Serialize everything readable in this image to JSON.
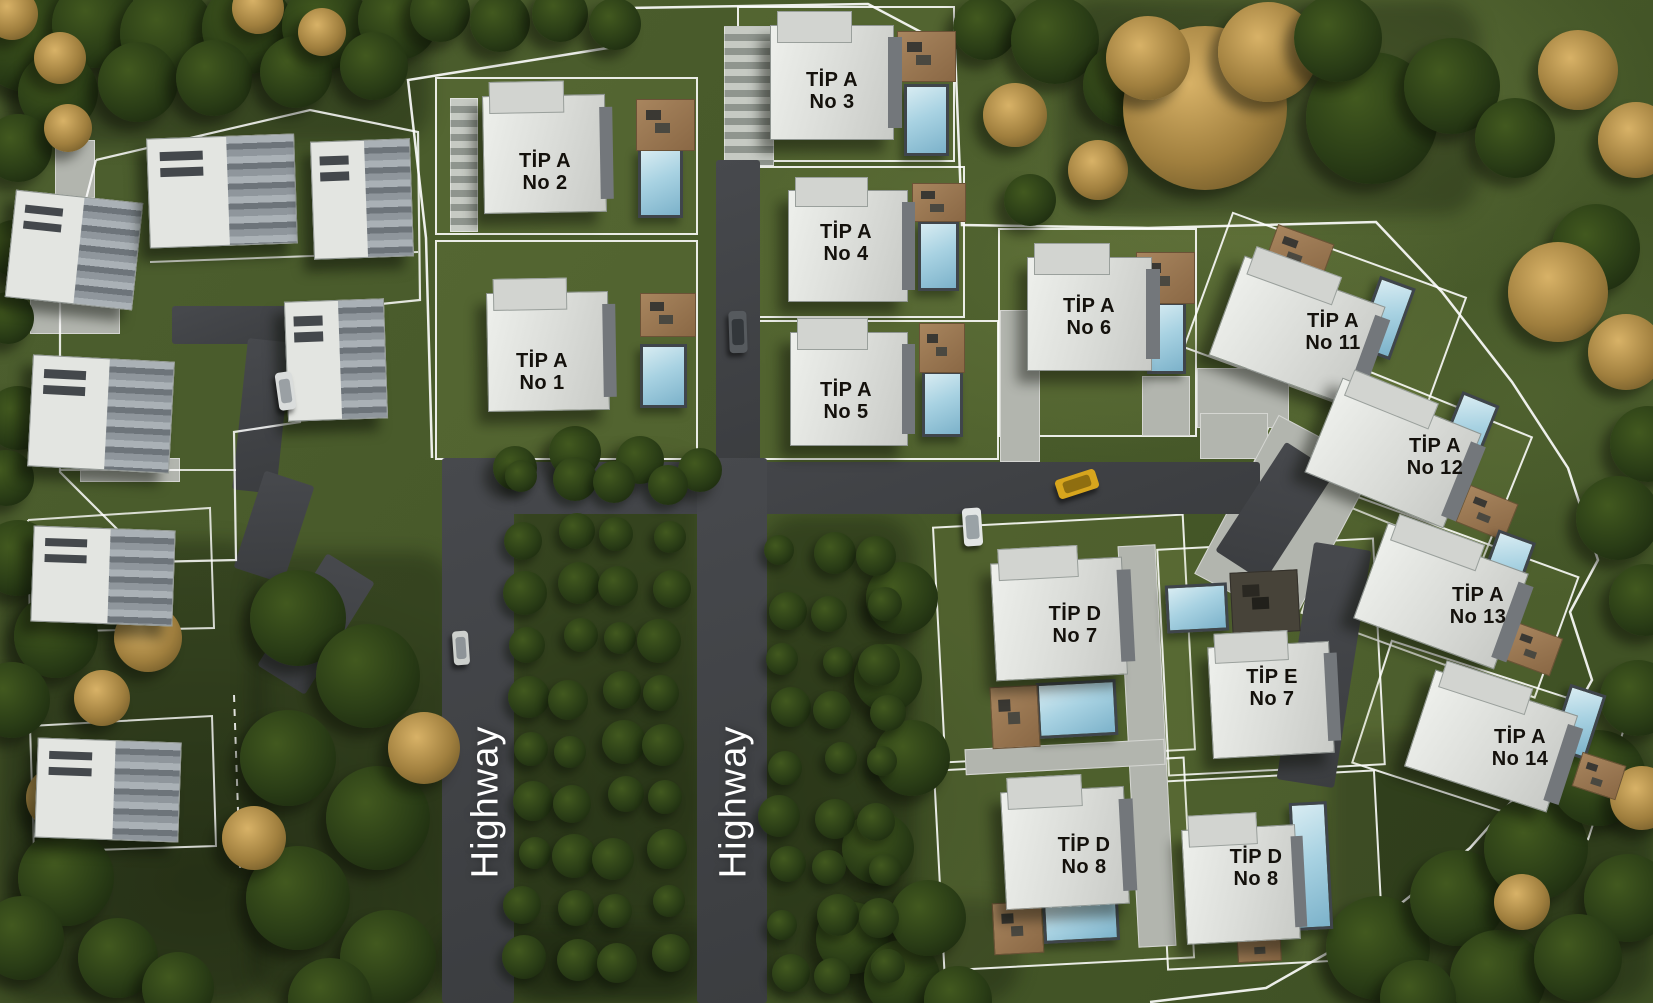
{
  "labels": {
    "highway_west": "Highway",
    "highway_east": "Highway"
  },
  "colors": {
    "grass": "#46572b",
    "asphalt": "#3e4043",
    "pavement": "#b2b5ae",
    "building": "#e0e2de",
    "pool": "#9ecbdd",
    "deck": "#8d6d4d",
    "boundary_line": "#ffffff",
    "label_text": "#14110c",
    "highway_text": "#ffffff",
    "taxi": "#d7a51d"
  },
  "villas": [
    {
      "name": "villa-tip-a-no-2",
      "type_label": "TİP A",
      "no_label": "No 2",
      "lot": [
        435,
        77,
        263,
        158,
        0
      ],
      "building": [
        483,
        95,
        121,
        116,
        -1
      ],
      "pool": [
        638,
        148,
        45,
        70,
        0
      ],
      "deck": [
        636,
        99,
        57,
        50,
        0
      ],
      "label": [
        545,
        172
      ]
    },
    {
      "name": "villa-tip-a-no-1",
      "type_label": "TİP A",
      "no_label": "No 1",
      "lot": [
        435,
        240,
        263,
        220,
        0
      ],
      "building": [
        487,
        292,
        120,
        117,
        -1
      ],
      "pool": [
        640,
        344,
        47,
        64,
        0
      ],
      "deck": [
        640,
        293,
        54,
        42,
        0
      ],
      "label": [
        542,
        372
      ]
    },
    {
      "name": "villa-tip-a-no-3",
      "type_label": "TİP A",
      "no_label": "No 3",
      "lot": [
        737,
        6,
        218,
        156,
        0
      ],
      "building": [
        770,
        25,
        122,
        113,
        0
      ],
      "pool": [
        904,
        84,
        45,
        72,
        0
      ],
      "deck": [
        897,
        31,
        57,
        49,
        0
      ],
      "label": [
        832,
        91
      ]
    },
    {
      "name": "villa-tip-a-no-4",
      "type_label": "TİP A",
      "no_label": "No 4",
      "lot": [
        737,
        166,
        228,
        152,
        0
      ],
      "building": [
        788,
        190,
        118,
        110,
        0
      ],
      "pool": [
        918,
        221,
        41,
        70,
        0
      ],
      "deck": [
        912,
        183,
        52,
        37,
        0
      ],
      "label": [
        846,
        243
      ]
    },
    {
      "name": "villa-tip-a-no-5",
      "type_label": "TİP A",
      "no_label": "No 5",
      "lot": [
        737,
        320,
        262,
        140,
        0
      ],
      "building": [
        790,
        332,
        116,
        112,
        0
      ],
      "pool": [
        922,
        371,
        41,
        66,
        0
      ],
      "deck": [
        919,
        323,
        44,
        48,
        0
      ],
      "label": [
        846,
        401
      ]
    },
    {
      "name": "villa-tip-a-no-6",
      "type_label": "TİP A",
      "no_label": "No 6",
      "lot": [
        998,
        228,
        199,
        209,
        0
      ],
      "building": [
        1027,
        257,
        123,
        112,
        0
      ],
      "pool": [
        1147,
        302,
        39,
        72,
        0
      ],
      "deck": [
        1136,
        252,
        57,
        50,
        0
      ],
      "label": [
        1089,
        317
      ]
    },
    {
      "name": "villa-tip-a-no-11",
      "type_label": "TİP A",
      "no_label": "No 11",
      "lot": [
        1200,
        250,
        250,
        145,
        20
      ],
      "building": [
        1222,
        278,
        148,
        104,
        20
      ],
      "pool": [
        1366,
        280,
        38,
        76,
        20
      ],
      "deck": [
        1269,
        233,
        58,
        41,
        20
      ],
      "label": [
        1333,
        332
      ]
    },
    {
      "name": "villa-tip-a-no-12",
      "type_label": "TİP A",
      "no_label": "No 12",
      "lot": [
        1267,
        385,
        250,
        135,
        22
      ],
      "building": [
        1318,
        402,
        148,
        100,
        22
      ],
      "pool": [
        1448,
        396,
        40,
        70,
        22
      ],
      "deck": [
        1461,
        493,
        50,
        38,
        22
      ],
      "label": [
        1435,
        457
      ]
    },
    {
      "name": "villa-tip-a-no-13",
      "type_label": "TİP A",
      "no_label": "No 13",
      "lot": [
        1315,
        530,
        250,
        130,
        20
      ],
      "building": [
        1366,
        545,
        148,
        100,
        20
      ],
      "pool": [
        1485,
        534,
        40,
        72,
        20
      ],
      "deck": [
        1508,
        629,
        48,
        38,
        20
      ],
      "label": [
        1478,
        606
      ]
    },
    {
      "name": "villa-tip-a-no-14",
      "type_label": "TİP A",
      "no_label": "No 14",
      "lot": [
        1365,
        675,
        250,
        130,
        18
      ],
      "building": [
        1416,
        690,
        148,
        100,
        18
      ],
      "pool": [
        1559,
        688,
        38,
        68,
        18
      ],
      "deck": [
        1576,
        758,
        44,
        34,
        18
      ],
      "label": [
        1520,
        748
      ]
    },
    {
      "name": "villa-tip-d-no-7",
      "type_label": "TİP D",
      "no_label": "No 7",
      "lot": [
        938,
        520,
        252,
        237,
        -3
      ],
      "building": [
        993,
        560,
        130,
        116,
        -3
      ],
      "pool": [
        1037,
        681,
        80,
        56,
        -3
      ],
      "deck": [
        991,
        686,
        46,
        60,
        -3
      ],
      "label": [
        1075,
        625
      ]
    },
    {
      "name": "villa-tip-e-no-7",
      "type_label": "TİP E",
      "no_label": "No 7",
      "lot": [
        1162,
        543,
        218,
        228,
        -3
      ],
      "building": [
        1210,
        644,
        120,
        110,
        -3
      ],
      "pool": [
        1166,
        584,
        62,
        48,
        -3
      ],
      "deck": [
        1231,
        571,
        66,
        60,
        -3
      ],
      "deck_dark": true,
      "label": [
        1272,
        688
      ]
    },
    {
      "name": "villa-tip-d-no-8-west",
      "type_label": "TİP D",
      "no_label": "No 8",
      "lot": [
        938,
        763,
        252,
        202,
        -3
      ],
      "building": [
        1003,
        789,
        122,
        116,
        -3
      ],
      "pool": [
        1043,
        898,
        76,
        44,
        -3
      ],
      "deck": [
        993,
        902,
        48,
        50,
        -3
      ],
      "label": [
        1084,
        856
      ]
    },
    {
      "name": "villa-tip-d-no-8-east",
      "type_label": "TİP D",
      "no_label": "No 8",
      "lot": [
        1162,
        775,
        218,
        190,
        -3
      ],
      "building": [
        1184,
        827,
        112,
        113,
        -3
      ],
      "pool": [
        1292,
        802,
        38,
        128,
        -3
      ],
      "deck": [
        1237,
        926,
        42,
        34,
        -3
      ],
      "label": [
        1256,
        868
      ]
    }
  ],
  "other_buildings": [
    {
      "name": "existing-building-west-1",
      "rect": [
        10,
        196,
        126,
        106,
        6
      ]
    },
    {
      "name": "existing-building-west-2",
      "rect": [
        148,
        136,
        146,
        108,
        -2
      ]
    },
    {
      "name": "existing-building-west-3",
      "rect": [
        312,
        140,
        98,
        116,
        -2
      ]
    },
    {
      "name": "existing-building-west-4",
      "rect": [
        30,
        358,
        140,
        110,
        3
      ]
    },
    {
      "name": "existing-building-west-5",
      "rect": [
        286,
        300,
        98,
        118,
        -2
      ]
    },
    {
      "name": "existing-building-west-6",
      "rect": [
        32,
        528,
        140,
        94,
        2
      ]
    },
    {
      "name": "existing-building-west-7",
      "rect": [
        36,
        740,
        142,
        98,
        2
      ]
    }
  ],
  "roads": [
    {
      "name": "main-road",
      "rect": [
        442,
        462,
        818,
        52,
        0
      ]
    },
    {
      "name": "road-bend-east",
      "rect": [
        1246,
        447,
        58,
        130,
        33
      ]
    },
    {
      "name": "road-east-south",
      "rect": [
        1295,
        545,
        58,
        240,
        9
      ]
    },
    {
      "name": "road-north-center",
      "rect": [
        716,
        160,
        44,
        302,
        0
      ]
    },
    {
      "name": "highway-west-road",
      "rect": [
        442,
        458,
        72,
        545,
        0
      ]
    },
    {
      "name": "highway-east-road",
      "rect": [
        697,
        458,
        70,
        545,
        0
      ]
    },
    {
      "name": "cluster-road-a",
      "rect": [
        172,
        306,
        142,
        38,
        0
      ]
    },
    {
      "name": "cluster-road-b",
      "rect": [
        240,
        340,
        44,
        152,
        6
      ]
    },
    {
      "name": "cluster-road-c",
      "rect": [
        248,
        476,
        52,
        102,
        18
      ]
    },
    {
      "name": "cluster-road-d",
      "rect": [
        288,
        558,
        56,
        132,
        32
      ]
    }
  ],
  "pavements": [
    {
      "name": "parking-strip-no2",
      "rect": [
        450,
        98,
        28,
        134,
        0
      ],
      "striped": true
    },
    {
      "name": "parking-strip-no3",
      "rect": [
        724,
        26,
        50,
        140,
        0
      ],
      "striped": true
    },
    {
      "name": "walkway-no6",
      "rect": [
        1000,
        310,
        40,
        152,
        0
      ]
    },
    {
      "name": "lounger-patio-no6",
      "rect": [
        1142,
        376,
        48,
        60,
        0
      ]
    },
    {
      "name": "driveway-no11",
      "rect": [
        1197,
        368,
        92,
        60,
        0
      ]
    },
    {
      "name": "driveway-no11-south",
      "rect": [
        1200,
        413,
        68,
        46,
        0
      ]
    },
    {
      "name": "driveway-east-villas",
      "rect": [
        1230,
        430,
        110,
        180,
        28
      ]
    },
    {
      "name": "walkway-southeast-vertical",
      "rect": [
        1128,
        545,
        38,
        402,
        -3
      ]
    },
    {
      "name": "walkway-southeast-horizontal",
      "rect": [
        965,
        744,
        200,
        26,
        -3
      ]
    },
    {
      "name": "pad-west-1",
      "rect": [
        30,
        298,
        90,
        36,
        0
      ]
    },
    {
      "name": "pad-west-2",
      "rect": [
        55,
        140,
        40,
        58,
        0
      ]
    },
    {
      "name": "pad-west-3",
      "rect": [
        80,
        458,
        100,
        24,
        0
      ]
    }
  ],
  "cars": [
    {
      "name": "yellow-taxi",
      "rect": [
        1056,
        474,
        42,
        20,
        -18
      ],
      "body": "#d7a51d",
      "glass": "#8f6e10"
    },
    {
      "name": "white-car-south",
      "rect": [
        963,
        508,
        19,
        38,
        -4
      ],
      "body": "#e3e6e5",
      "glass": "#9aa2a6"
    },
    {
      "name": "gray-car-north",
      "rect": [
        729,
        311,
        18,
        42,
        -2
      ],
      "body": "#565a5e",
      "glass": "#33373b"
    },
    {
      "name": "white-car-west",
      "rect": [
        277,
        372,
        17,
        38,
        -8
      ],
      "body": "#dadddc",
      "glass": "#9aa0a4"
    },
    {
      "name": "white-car-orchard",
      "rect": [
        453,
        631,
        16,
        34,
        -4
      ],
      "body": "#cdd0cd",
      "glass": "#8e9498"
    }
  ],
  "trees": [
    [
      28,
      38,
      54,
      "d"
    ],
    [
      96,
      24,
      44,
      "d"
    ],
    [
      168,
      34,
      48,
      "d"
    ],
    [
      248,
      28,
      46,
      "d"
    ],
    [
      326,
      26,
      44,
      "d"
    ],
    [
      398,
      20,
      40,
      "d"
    ],
    [
      58,
      92,
      40,
      "d"
    ],
    [
      138,
      82,
      40,
      "d"
    ],
    [
      214,
      78,
      38,
      "d"
    ],
    [
      296,
      72,
      36,
      "d"
    ],
    [
      374,
      66,
      34,
      "d"
    ],
    [
      18,
      148,
      34,
      "d"
    ],
    [
      440,
      12,
      30,
      "d"
    ],
    [
      500,
      22,
      30,
      "d"
    ],
    [
      560,
      14,
      28,
      "d"
    ],
    [
      615,
      24,
      26,
      "d"
    ],
    [
      12,
      14,
      26,
      "g"
    ],
    [
      258,
      8,
      26,
      "g"
    ],
    [
      322,
      32,
      24,
      "g"
    ],
    [
      60,
      58,
      26,
      "g"
    ],
    [
      68,
      128,
      24,
      "g"
    ],
    [
      985,
      28,
      32,
      "d"
    ],
    [
      1055,
      40,
      44,
      "d"
    ],
    [
      1125,
      85,
      42,
      "d"
    ],
    [
      1015,
      115,
      32,
      "g"
    ],
    [
      1098,
      170,
      30,
      "g"
    ],
    [
      1030,
      200,
      26,
      "d"
    ],
    [
      1205,
      108,
      82,
      "g"
    ],
    [
      1268,
      52,
      50,
      "g"
    ],
    [
      1148,
      58,
      42,
      "g"
    ],
    [
      1372,
      118,
      66,
      "d"
    ],
    [
      1452,
      86,
      48,
      "d"
    ],
    [
      1338,
      38,
      44,
      "d"
    ],
    [
      1515,
      138,
      40,
      "d"
    ],
    [
      1578,
      70,
      40,
      "g"
    ],
    [
      1636,
      140,
      38,
      "g"
    ],
    [
      1596,
      248,
      44,
      "d"
    ],
    [
      1558,
      292,
      50,
      "g"
    ],
    [
      1626,
      352,
      38,
      "g"
    ],
    [
      1648,
      444,
      38,
      "d"
    ],
    [
      1618,
      518,
      42,
      "d"
    ],
    [
      1645,
      600,
      36,
      "d"
    ],
    [
      14,
      248,
      28,
      "d"
    ],
    [
      8,
      318,
      26,
      "d"
    ],
    [
      18,
      418,
      32,
      "d"
    ],
    [
      6,
      478,
      28,
      "d"
    ],
    [
      18,
      558,
      38,
      "d"
    ],
    [
      56,
      636,
      42,
      "d"
    ],
    [
      12,
      700,
      38,
      "d"
    ],
    [
      66,
      878,
      48,
      "d"
    ],
    [
      22,
      938,
      42,
      "d"
    ],
    [
      118,
      958,
      40,
      "d"
    ],
    [
      178,
      988,
      36,
      "d"
    ],
    [
      148,
      638,
      34,
      "g"
    ],
    [
      102,
      698,
      28,
      "g"
    ],
    [
      58,
      798,
      32,
      "g"
    ],
    [
      298,
      618,
      48,
      "d"
    ],
    [
      368,
      676,
      52,
      "d"
    ],
    [
      288,
      758,
      48,
      "d"
    ],
    [
      378,
      818,
      52,
      "d"
    ],
    [
      298,
      898,
      52,
      "d"
    ],
    [
      388,
      958,
      48,
      "d"
    ],
    [
      330,
      1000,
      42,
      "d"
    ],
    [
      424,
      748,
      36,
      "g"
    ],
    [
      254,
      838,
      32,
      "g"
    ],
    [
      515,
      468,
      22,
      "d"
    ],
    [
      575,
      452,
      26,
      "d"
    ],
    [
      640,
      460,
      24,
      "d"
    ],
    [
      700,
      470,
      22,
      "d"
    ],
    [
      852,
      938,
      36,
      "d"
    ],
    [
      902,
      978,
      38,
      "d"
    ],
    [
      958,
      1000,
      34,
      "d"
    ],
    [
      902,
      598,
      36,
      "d"
    ],
    [
      888,
      678,
      34,
      "d"
    ],
    [
      912,
      758,
      38,
      "d"
    ],
    [
      878,
      848,
      36,
      "d"
    ],
    [
      928,
      918,
      38,
      "d"
    ],
    [
      1378,
      948,
      52,
      "d"
    ],
    [
      1458,
      898,
      48,
      "d"
    ],
    [
      1536,
      848,
      52,
      "d"
    ],
    [
      1598,
      778,
      48,
      "d"
    ],
    [
      1628,
      898,
      44,
      "d"
    ],
    [
      1498,
      978,
      48,
      "d"
    ],
    [
      1578,
      958,
      44,
      "d"
    ],
    [
      1638,
      698,
      38,
      "d"
    ],
    [
      1418,
      998,
      38,
      "d"
    ],
    [
      1522,
      902,
      28,
      "g"
    ],
    [
      1642,
      798,
      32,
      "g"
    ]
  ],
  "groves": [
    {
      "name": "orchard-central",
      "x0": 528,
      "y0": 482,
      "cols": 4,
      "rows": 10,
      "dx": 46,
      "dy": 53,
      "r": 19
    },
    {
      "name": "orchard-east",
      "x0": 786,
      "y0": 556,
      "cols": 3,
      "rows": 9,
      "dx": 48,
      "dy": 52,
      "r": 18
    }
  ],
  "shade_patches": [
    [
      0,
      0,
      430,
      145,
      0
    ],
    [
      1060,
      0,
      420,
      215,
      0
    ],
    [
      0,
      540,
      265,
      463,
      0
    ],
    [
      250,
      552,
      205,
      451,
      0
    ],
    [
      510,
      456,
      192,
      547,
      0
    ],
    [
      760,
      516,
      155,
      487,
      0
    ],
    [
      1330,
      735,
      323,
      268,
      0
    ],
    [
      430,
      925,
      340,
      78,
      0
    ],
    [
      830,
      900,
      190,
      103,
      0
    ]
  ]
}
